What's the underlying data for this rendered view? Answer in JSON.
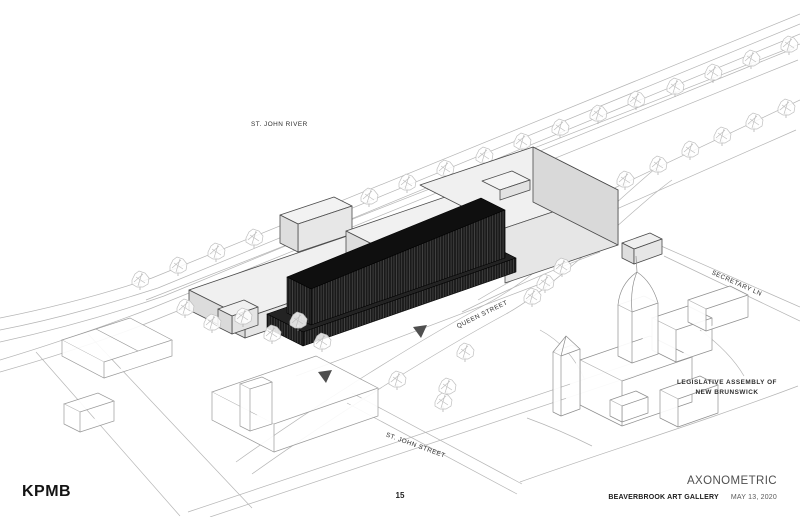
{
  "slide": {
    "logo": "KPMB",
    "page_number": "15",
    "title": "AXONOMETRIC",
    "project": "BEAVERBROOK ART GALLERY",
    "date": "MAY 13, 2020"
  },
  "drawing": {
    "labels": {
      "river": "ST. JOHN RIVER",
      "queen_street": "QUEEN STREET",
      "secretary_lane": "SECRETARY LN",
      "st_john_street": "ST. JOHN STREET",
      "assembly_line1": "LEGISLATIVE ASSEMBLY OF",
      "assembly_line2": "NEW BRUNSWICK"
    },
    "colors": {
      "new_addition_dark": "#161616",
      "addition_stripe": "#555555",
      "existing_building_fill": "#ededed",
      "terrain_line": "#b5b5b5",
      "wireframe_line": "#949494",
      "label_text": "#2e2e2e"
    }
  }
}
